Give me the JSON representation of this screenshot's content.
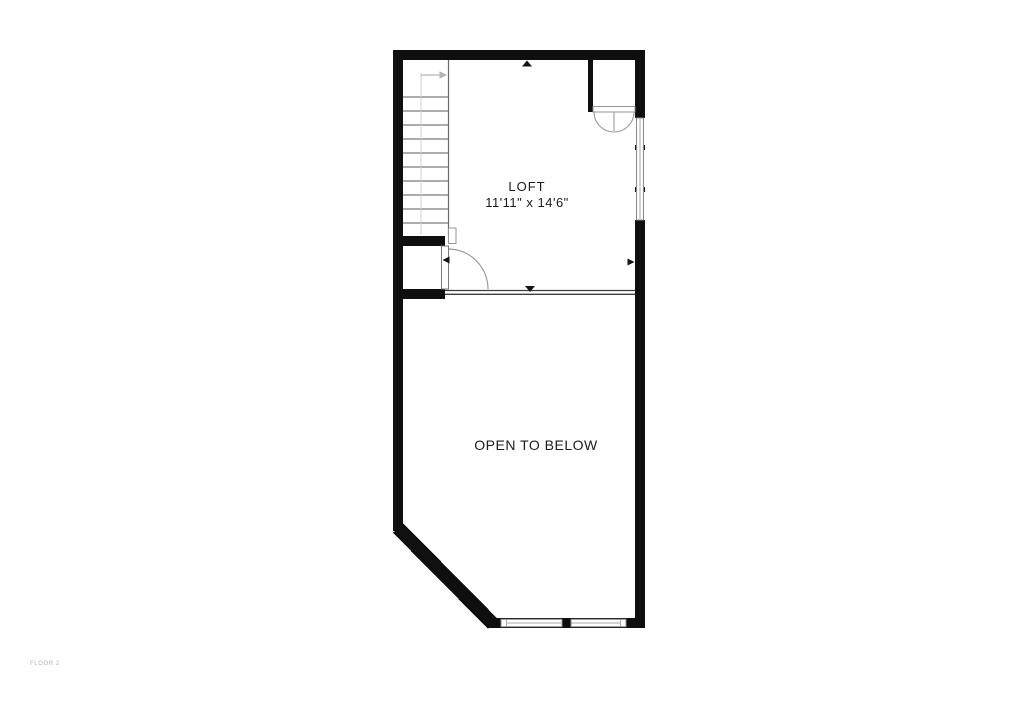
{
  "floor_plan": {
    "floor_label": "FLOOR 2",
    "rooms": {
      "loft": {
        "name": "LOFT",
        "dimensions": "11'11\" x 14'6\""
      },
      "open_to_below": {
        "label": "OPEN TO BELOW"
      }
    },
    "colors": {
      "background": "#ffffff",
      "wall": "#0f0f0f",
      "tread_line": "#5a5a5a",
      "stair_boundary": "#6a6a6a",
      "walk_line": "#cfcfcf",
      "stair_arrow": "#b3b3b3",
      "door_arc": "#9a9a9a",
      "door_leaf_frame": "#7a7a7a",
      "window_frame": "#8a8a8a",
      "railing": "#3f3f3f",
      "extent_marker": "#141414",
      "room_text": "#1c1c1c",
      "floor_label_text": "#b4b4b4"
    },
    "icons": {
      "stairs_direction_arrow": "right-arrow",
      "extent_marker_up": "triangle-up",
      "extent_marker_down": "triangle-down",
      "extent_marker_left": "triangle-left",
      "extent_marker_right": "triangle-right"
    }
  }
}
